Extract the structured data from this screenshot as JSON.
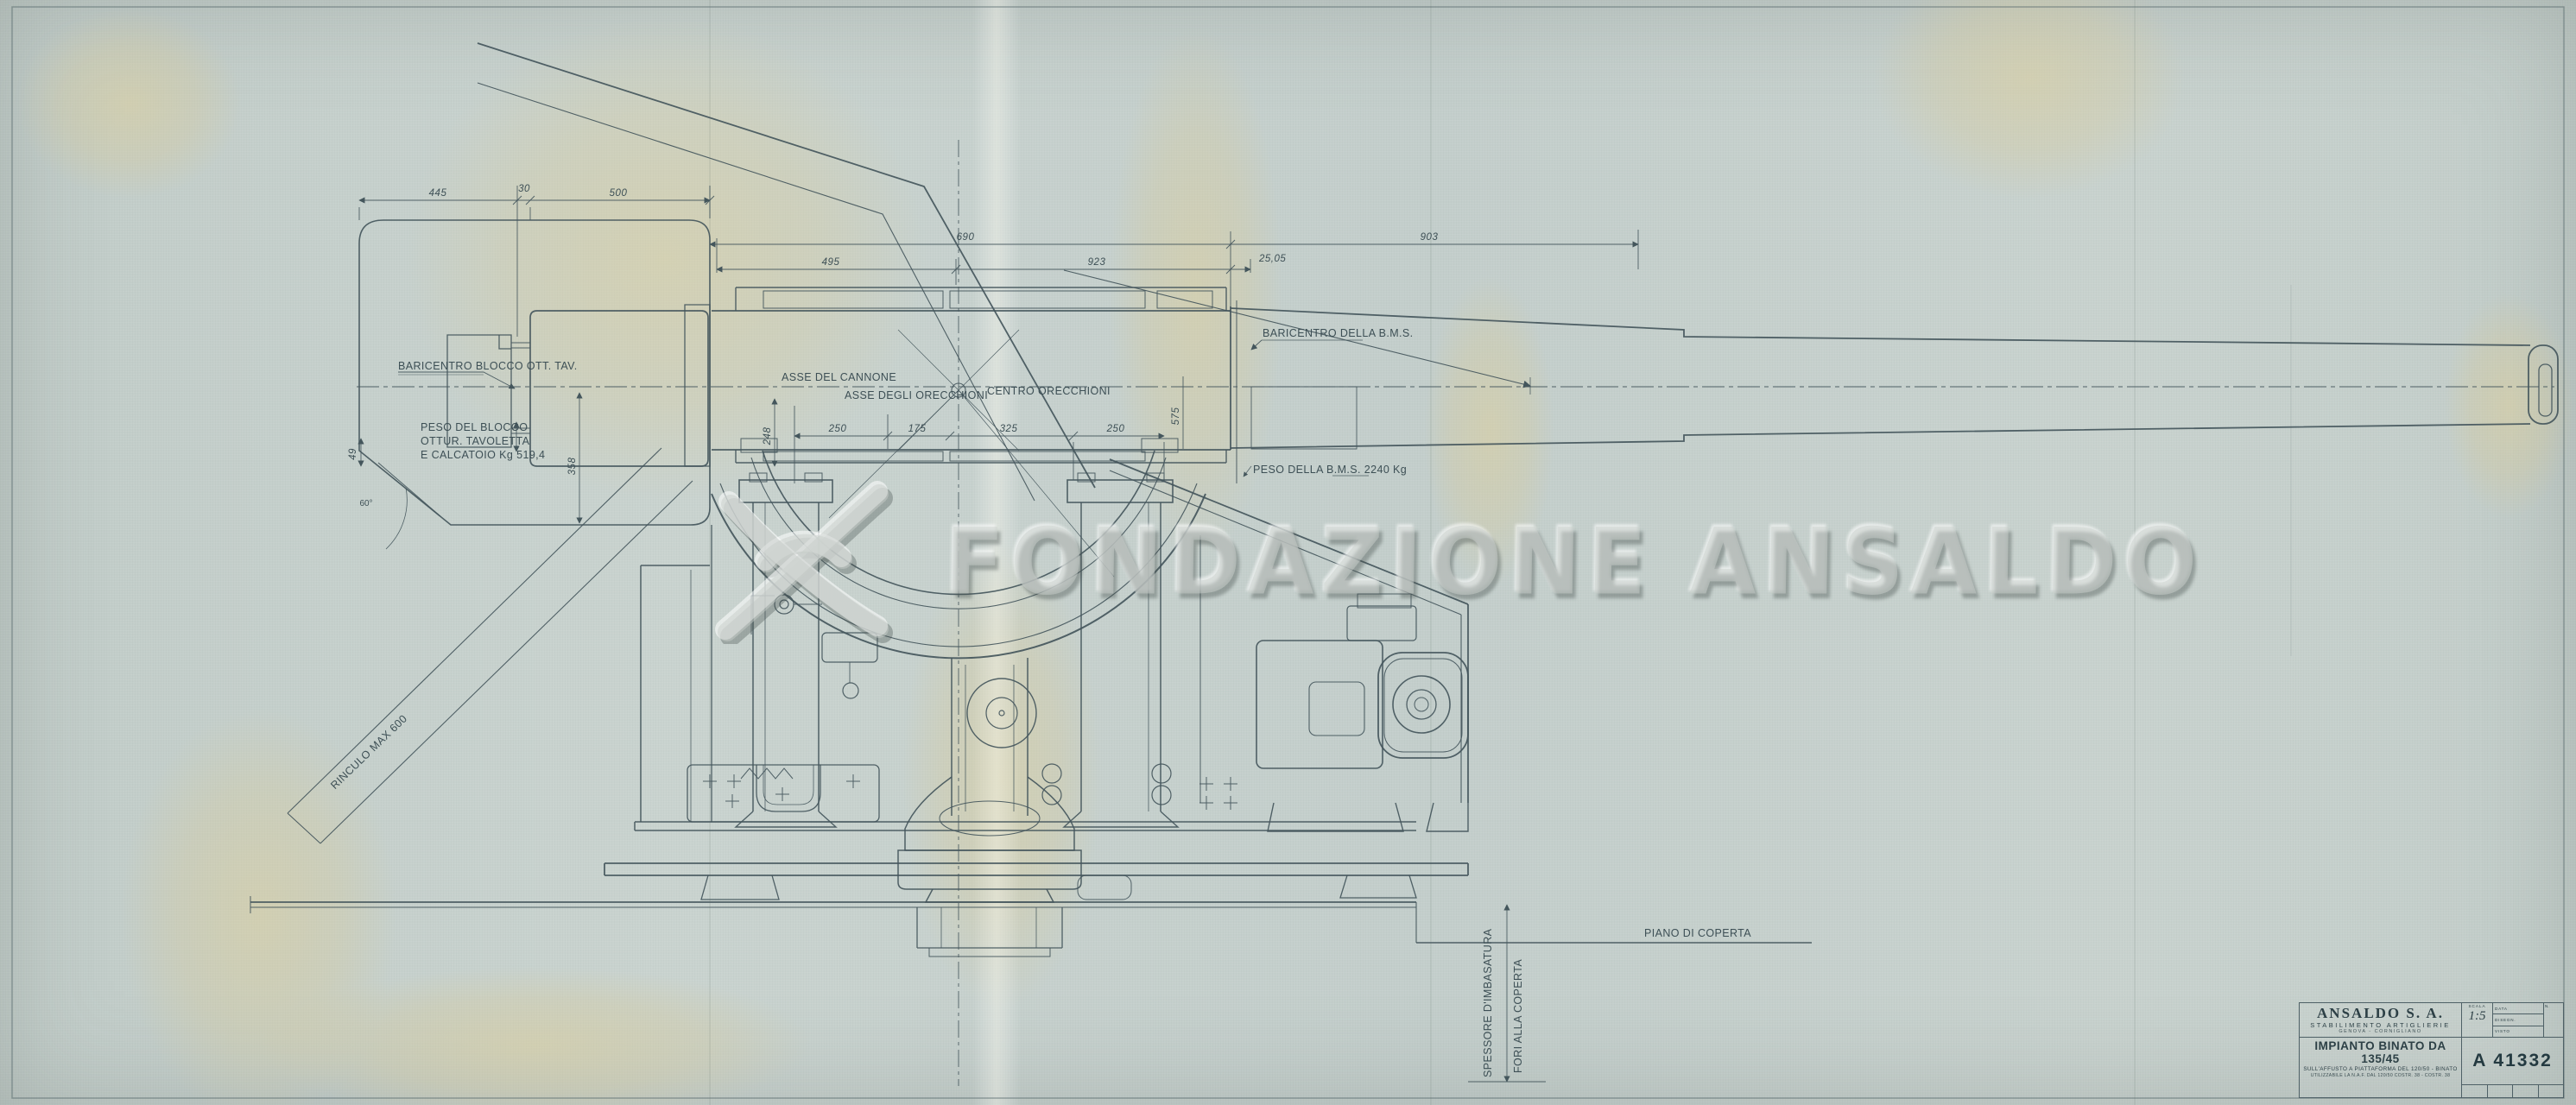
{
  "sheet": {
    "background": "#c6d0cc",
    "ink": "#44565c",
    "stain": "#d9cb98",
    "border": "#5a6c70"
  },
  "watermark": {
    "text": "FONDAZIONE ANSALDO",
    "logo": "ansaldo-crossed-swoosh-logo"
  },
  "title_block": {
    "company": "ANSALDO S. A.",
    "department": "STABILIMENTO ARTIGLIERIE",
    "location": "GENOVA - CORNIGLIANO",
    "drawing_title": "IMPIANTO BINATO DA 135/45",
    "subtitle1": "SULL'AFFUSTO A PIATTAFORMA DEL 120/50 - BINATO",
    "subtitle2": "UTILIZZABILE LA N.A.F. DAL 120/50 COSTR. 38 - COSTR. 38",
    "scale_label": "SCALA",
    "scale_value": "1:5",
    "field_data": "DATA",
    "field_disegn": "DISEGN.",
    "field_visto": "VISTO",
    "field_n": "N.",
    "drawing_number": "A 41332"
  },
  "annotations": {
    "baricentro_blocco": "BARICENTRO BLOCCO OTT. TAV.",
    "peso_blocco_1": "PESO DEL BLOCCO",
    "peso_blocco_2": "OTTUR. TAVOLETTA",
    "peso_blocco_3": "E CALCATOIO Kg 519,4",
    "asse_cannone": "ASSE DEL CANNONE",
    "asse_orecchioni": "ASSE DEGLI ORECCHIONI",
    "centro_orecchioni": "CENTRO ORECCHIONI",
    "baricentro_bms": "BARICENTRO DELLA B.M.S.",
    "peso_bms": "PESO DELLA B.M.S. 2240 Kg",
    "rinculo": "RINCULO MAX 600",
    "piano_coperta": "PIANO DI COPERTA",
    "spessore_imbasatura": "SPESSORE D'IMBASATURA",
    "fori_coperta": "FORI ALLA COPERTA"
  },
  "dimensions": {
    "d445": "445",
    "d30": "30",
    "d500": "500",
    "d690": "690",
    "d903": "903",
    "d495": "495",
    "d923": "923",
    "d2505": "25,05",
    "d250a": "250",
    "d175": "175",
    "d325": "325",
    "d250b": "250",
    "d358": "358",
    "d248": "248",
    "d575": "575",
    "d49": "49",
    "d60": "60°"
  }
}
